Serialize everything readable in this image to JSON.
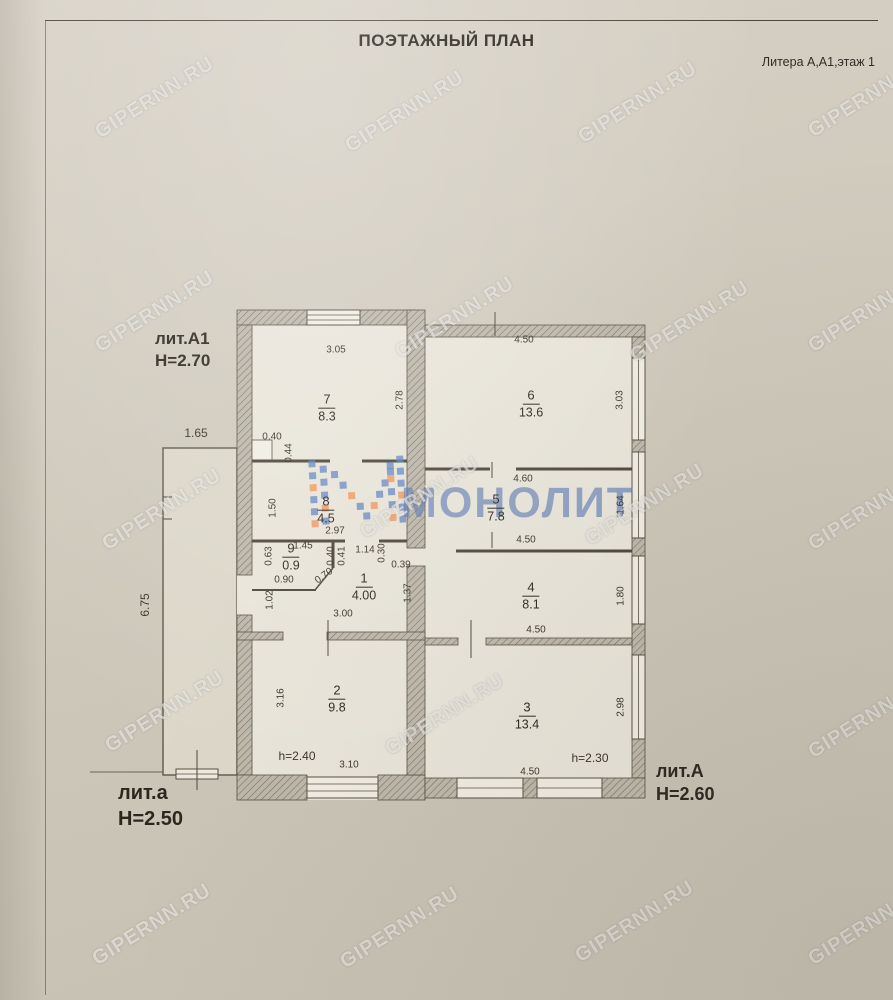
{
  "page": {
    "title": "ПОЭТАЖНЫЙ ПЛАН",
    "litera_note": "Литера А,А1,этаж 1"
  },
  "theme": {
    "paper": "#d0cabd",
    "ink": "#3a342b",
    "wall_fill": "#beb8ab",
    "wall_hatch": "#787264",
    "brand_blue": "#5b82c3",
    "brand_orange": "#ef9357",
    "watermark_color": "rgba(255,255,255,0.55)"
  },
  "brand": {
    "name": "МОНОЛИТ"
  },
  "watermark": {
    "text": "GIPERNN.RU",
    "positions": [
      [
        155,
        98
      ],
      [
        405,
        112
      ],
      [
        638,
        103
      ],
      [
        868,
        97
      ],
      [
        155,
        312
      ],
      [
        455,
        318
      ],
      [
        690,
        322
      ],
      [
        868,
        312
      ],
      [
        162,
        510
      ],
      [
        420,
        498
      ],
      [
        645,
        505
      ],
      [
        868,
        510
      ],
      [
        165,
        712
      ],
      [
        445,
        715
      ],
      [
        868,
        718
      ],
      [
        152,
        925
      ],
      [
        400,
        928
      ],
      [
        635,
        922
      ],
      [
        868,
        925
      ]
    ]
  },
  "building_labels": [
    {
      "name": "лит.А1",
      "height": "Н=2.70",
      "x": 155,
      "y": 328,
      "size": 17
    },
    {
      "name": "лит.а",
      "height": "Н=2.50",
      "x": 118,
      "y": 780,
      "size": 20
    },
    {
      "name": "лит.А",
      "height": "Н=2.60",
      "x": 656,
      "y": 760,
      "size": 18
    }
  ],
  "rooms": [
    {
      "number": "7",
      "area": "8.3",
      "x": 327,
      "y": 408
    },
    {
      "number": "6",
      "area": "13.6",
      "x": 531,
      "y": 404
    },
    {
      "number": "8",
      "area": "4.5",
      "x": 326,
      "y": 510
    },
    {
      "number": "5",
      "area": "7.8",
      "x": 496,
      "y": 508
    },
    {
      "number": "9",
      "area": "0.9",
      "x": 291,
      "y": 557
    },
    {
      "number": "1",
      "area": "4.00",
      "x": 364,
      "y": 587
    },
    {
      "number": "4",
      "area": "8.1",
      "x": 531,
      "y": 596
    },
    {
      "number": "2",
      "area": "9.8",
      "x": 337,
      "y": 699
    },
    {
      "number": "3",
      "area": "13.4",
      "x": 527,
      "y": 716
    }
  ],
  "dimensions": [
    {
      "t": "3.05",
      "x": 336,
      "y": 350
    },
    {
      "t": "2.78",
      "x": 400,
      "y": 400,
      "r": -90
    },
    {
      "t": "4.50",
      "x": 524,
      "y": 340
    },
    {
      "t": "3.03",
      "x": 620,
      "y": 400,
      "r": -90
    },
    {
      "t": "0.40",
      "x": 272,
      "y": 437
    },
    {
      "t": "0.44",
      "x": 289,
      "y": 453,
      "r": -90
    },
    {
      "t": "1.65",
      "x": 196,
      "y": 433,
      "s": 12
    },
    {
      "t": "1.50",
      "x": 273,
      "y": 508,
      "r": -90
    },
    {
      "t": "2.97",
      "x": 335,
      "y": 531
    },
    {
      "t": "4.60",
      "x": 523,
      "y": 479
    },
    {
      "t": "4.50",
      "x": 526,
      "y": 540
    },
    {
      "t": "1.64",
      "x": 621,
      "y": 505,
      "r": -90
    },
    {
      "t": "6.75",
      "x": 145,
      "y": 605,
      "r": -90,
      "s": 12
    },
    {
      "t": "1.45",
      "x": 303,
      "y": 546
    },
    {
      "t": "0.63",
      "x": 269,
      "y": 556,
      "r": -90
    },
    {
      "t": "0.90",
      "x": 284,
      "y": 580
    },
    {
      "t": "0.70",
      "x": 324,
      "y": 576,
      "r": -36
    },
    {
      "t": "1.02",
      "x": 270,
      "y": 600,
      "r": -90
    },
    {
      "t": "0.40",
      "x": 331,
      "y": 556,
      "r": -90
    },
    {
      "t": "0.41",
      "x": 342,
      "y": 556,
      "r": -90
    },
    {
      "t": "1.14",
      "x": 365,
      "y": 550
    },
    {
      "t": "0.30",
      "x": 382,
      "y": 553,
      "r": -90
    },
    {
      "t": "0.39",
      "x": 401,
      "y": 565
    },
    {
      "t": "3.00",
      "x": 343,
      "y": 614
    },
    {
      "t": "1.37",
      "x": 408,
      "y": 593,
      "r": -90
    },
    {
      "t": "4.50",
      "x": 536,
      "y": 630
    },
    {
      "t": "1.80",
      "x": 621,
      "y": 596,
      "r": -90
    },
    {
      "t": "3.16",
      "x": 281,
      "y": 698,
      "r": -90
    },
    {
      "t": "3.10",
      "x": 349,
      "y": 765
    },
    {
      "t": "h=2.40",
      "x": 297,
      "y": 756,
      "s": 12
    },
    {
      "t": "h=2.30",
      "x": 590,
      "y": 758,
      "s": 12
    },
    {
      "t": "4.50",
      "x": 530,
      "y": 772
    },
    {
      "t": "2.98",
      "x": 621,
      "y": 707,
      "r": -90
    }
  ]
}
